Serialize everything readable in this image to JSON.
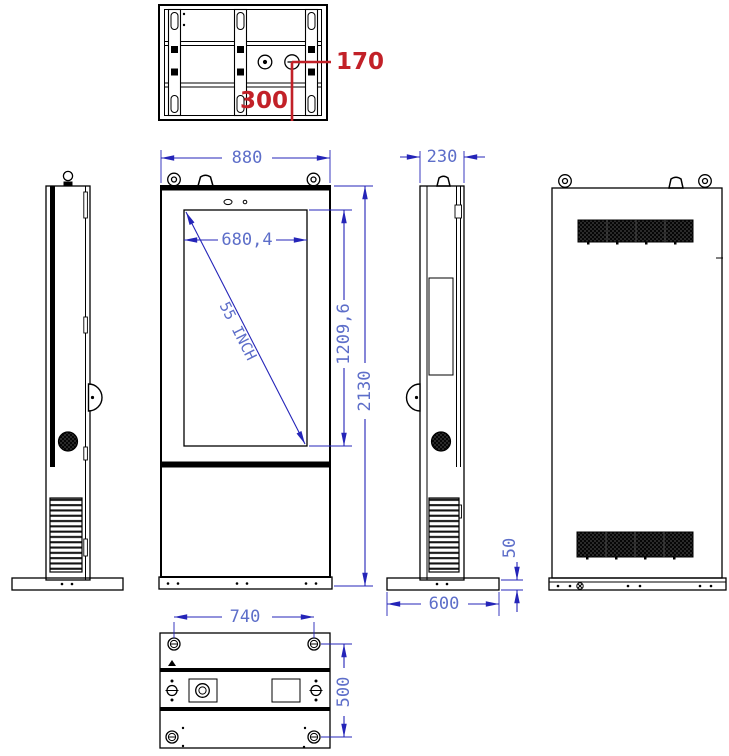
{
  "drawing": {
    "type": "outdoor-digital-signage-totem-orthographic-views",
    "units_note": "",
    "colors": {
      "line_black": "#000000",
      "dimension_blue_line": "#2424b8",
      "dimension_blue_text": "#5d6ec9",
      "annotation_red": "#c22128",
      "vent_dark": "#2a2a2a"
    }
  },
  "dimensions": {
    "top_hole_offset_x": "170",
    "top_hole_offset_y": "300",
    "front_width": "880",
    "display_width": "680,4",
    "display_height": "1209,6",
    "overall_height": "2130",
    "display_diagonal": "55 INCH",
    "side_depth": "230",
    "base_height": "50",
    "base_depth": "600",
    "bottom_bolt_span_width": "740",
    "bottom_bolt_span_depth": "500"
  }
}
